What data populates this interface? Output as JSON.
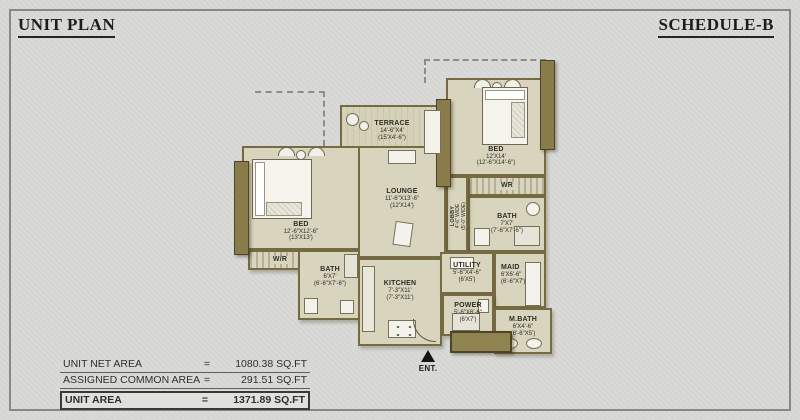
{
  "header": {
    "title": "UNIT PLAN",
    "schedule": "SCHEDULE-B"
  },
  "rooms": [
    {
      "id": "terrace",
      "name": "TERRACE",
      "dim1": "14'-6\"X4'",
      "dim2": "(15'X4'-6\")"
    },
    {
      "id": "bed-right",
      "name": "BED",
      "dim1": "12'X14'",
      "dim2": "(12'-6\"X14'-6\")"
    },
    {
      "id": "wr-right",
      "name": "WR"
    },
    {
      "id": "bath-right",
      "name": "BATH",
      "dim1": "7'X7'",
      "dim2": "(7'-6\"X7'-6\")"
    },
    {
      "id": "lobby",
      "name": "LOBBY",
      "dim1": "4'-6\" WIDE",
      "dim2": "(5'-0\" WIDE)"
    },
    {
      "id": "bed-left",
      "name": "BED",
      "dim1": "12'-6\"X12'-6\"",
      "dim2": "(13'X13')"
    },
    {
      "id": "wr-left",
      "name": "W/R"
    },
    {
      "id": "bath-left",
      "name": "BATH",
      "dim1": "6'X7'",
      "dim2": "(6'-6\"X7'-6\")"
    },
    {
      "id": "lounge",
      "name": "LOUNGE",
      "dim1": "11'-6\"X13'-6\"",
      "dim2": "(12'X14')"
    },
    {
      "id": "kitchen",
      "name": "KITCHEN",
      "dim1": "7'-3\"X11'",
      "dim2": "(7'-3\"X11')"
    },
    {
      "id": "utility",
      "name": "UTILITY",
      "dim1": "5'-6\"X4'-6\"",
      "dim2": "(6'X5')"
    },
    {
      "id": "maid",
      "name": "MAID",
      "dim1": "6'X6'-6\"",
      "dim2": "(6'-6\"X7')"
    },
    {
      "id": "power",
      "name": "POWER",
      "dim1": "5'-6\"X6'-6\"",
      "dim2": "(6'X7')"
    },
    {
      "id": "mbath",
      "name": "M.BATH",
      "dim1": "6'X4'-6\"",
      "dim2": "(6'-6\"X5')"
    }
  ],
  "entrance": {
    "label": "ENT."
  },
  "stats": {
    "rows": [
      {
        "label": "UNIT NET AREA",
        "eq": "=",
        "value": "1080.38 SQ.FT"
      },
      {
        "label": "ASSIGNED COMMON AREA",
        "eq": "=",
        "value": "291.51 SQ.FT"
      },
      {
        "label": "UNIT AREA",
        "eq": "=",
        "value": "1371.89 SQ.FT"
      }
    ]
  },
  "colors": {
    "background": "#dadad8",
    "floor": "#d8d4bd",
    "wall": "#756a42",
    "wall_dark": "#897c4a",
    "text": "#2f2d26"
  }
}
